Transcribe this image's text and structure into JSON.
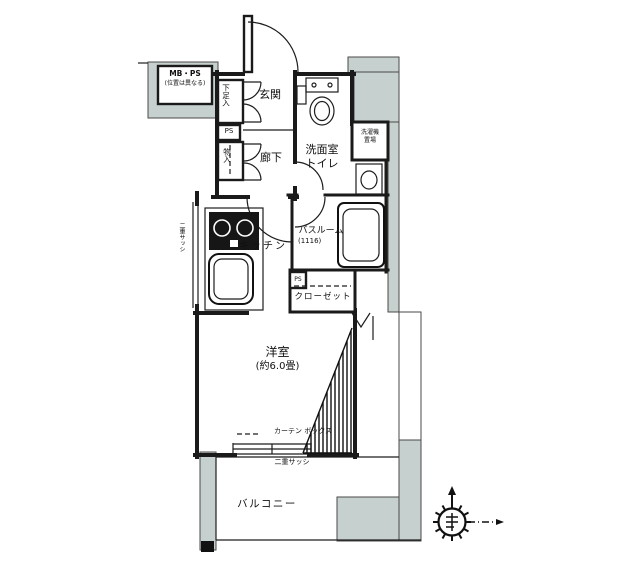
{
  "plan": {
    "rooms": {
      "genkan": "玄関",
      "rouka": "廊下",
      "washroom_line1": "洗面室",
      "washroom_line2": "トイレ",
      "kitchen": "キッチン",
      "bath_line1": "バスルーム",
      "bath_line2": "(1116)",
      "closet": "クローゼット",
      "main_line1": "洋室",
      "main_line2": "(約6.0畳)",
      "balcony": "バルコニー"
    },
    "storage": {
      "shoe_box": "下足入",
      "mono_ire": "物入",
      "ps_upper": "PS",
      "ps_lower": "PS",
      "mb_ps_line1": "MB・PS",
      "mb_ps_line2": "(位置は異なる)",
      "laundry_line1": "洗濯機",
      "laundry_line2": "置場"
    },
    "annotations": {
      "curtain_box": "カーテン ボックス",
      "double_sash_window": "二重サッシ",
      "double_sash_side": "二重サッシ"
    },
    "colors": {
      "wall": "#1a1a1a",
      "shade": "#c5d0cf",
      "background": "#ffffff"
    }
  }
}
